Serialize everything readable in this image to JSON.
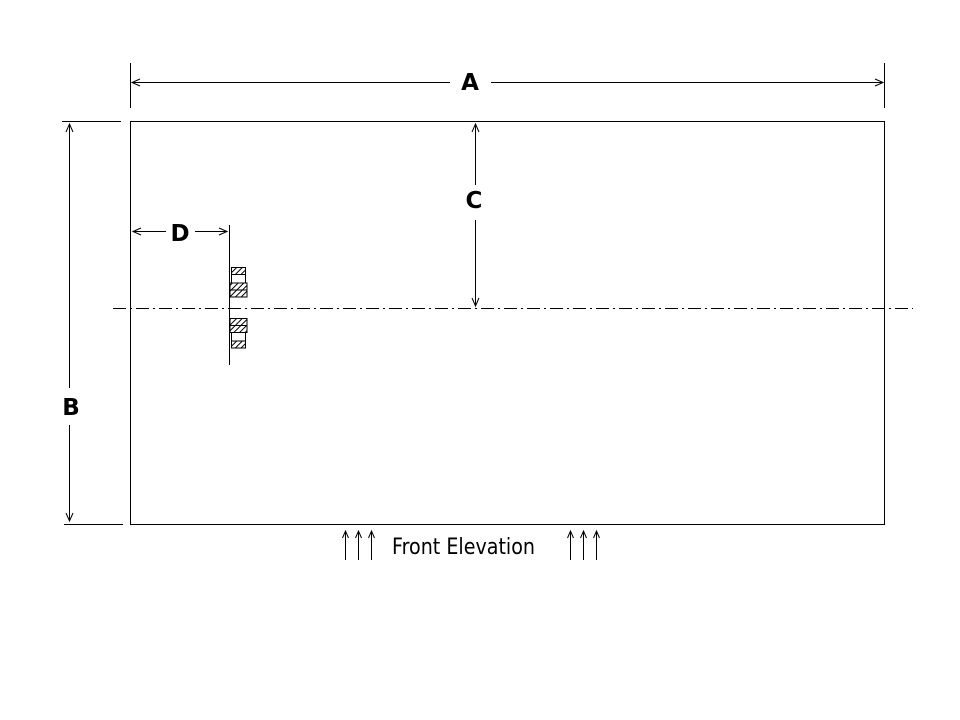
{
  "drawing": {
    "type": "technical-elevation-drawing",
    "colors": {
      "background": "#ffffff",
      "line": "#000000"
    },
    "labels": {
      "a": "A",
      "b": "B",
      "c": "C",
      "d": "D"
    },
    "caption": {
      "text": "Front Elevation"
    }
  }
}
